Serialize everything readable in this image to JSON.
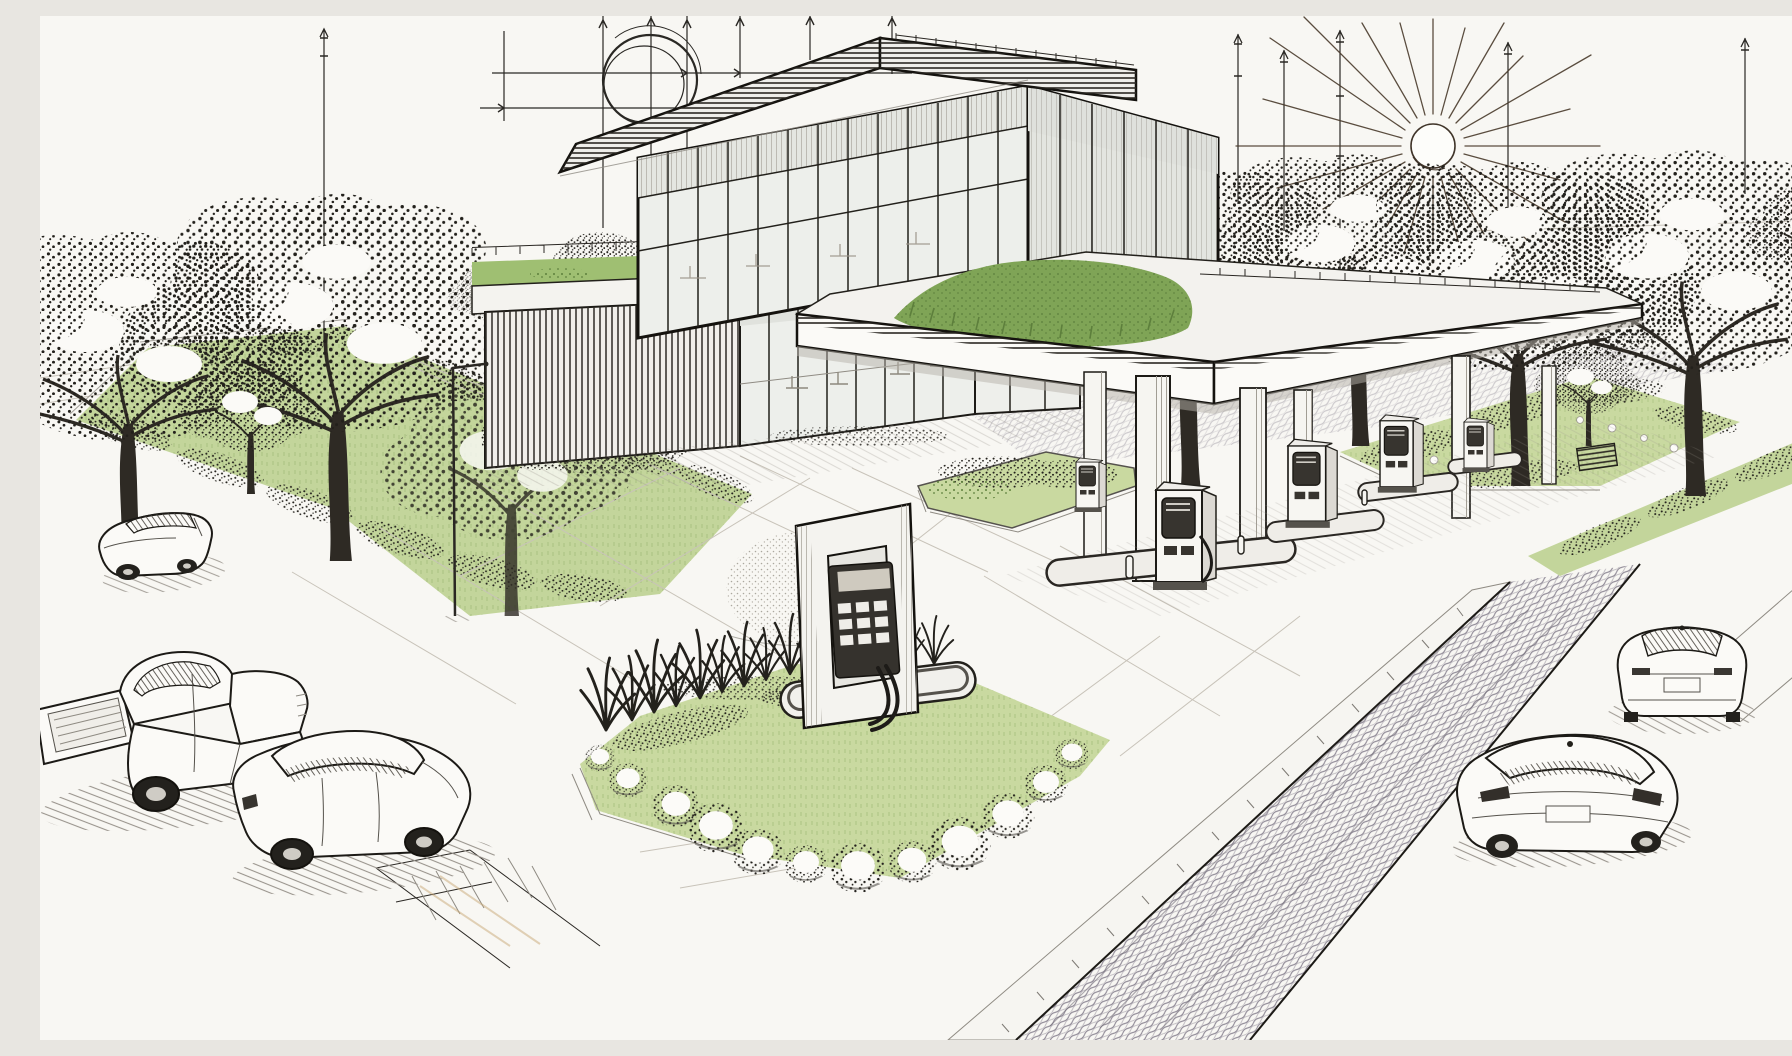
{
  "artwork": {
    "type": "architectural concept sketch",
    "medium": "ink line drawing with green wash accents",
    "view": "aerial three-quarter perspective",
    "subject": "eco gas station and EV charging forecourt with glass convenience building, planted green roofs, landscaped lawns, trees and cars"
  },
  "palette": {
    "paper": "#f8f7f3",
    "ink": "#22201b",
    "line_soft": "#8f8b83",
    "line_faint": "#c8c3b9",
    "sun_disc": "#fdfdfa",
    "sun_ray": "#4a3b2c",
    "lawn_light": "#c9d9a0",
    "lawn_mid": "#c3d59b",
    "lawn_deep": "#9fbf72",
    "plant_green": "#7fa456",
    "plant_green_dark": "#5d7f3c",
    "glass_light": "#edefeb",
    "glass_shade": "#e3e5e0",
    "surface_white": "#fbfaf7",
    "road_hatch": "#8d8794",
    "road_hatch_dark": "#6f6a74",
    "shadow_line": "#9a958e",
    "tan_accent": "#c7a876",
    "panel_dark": "#37342f"
  },
  "scene": {
    "sky_elements": [
      "sketched sun with radiating rays",
      "surveyor guide circle",
      "perspective guide lines with arrowheads",
      "antenna guide poles"
    ],
    "building": {
      "description": "two-storey glass pavilion",
      "features": [
        "flat overhanging hatched roof slab",
        "glass curtain wall",
        "green roof terrace with railing",
        "vertical louver screen",
        "storefront glazing with interior furniture"
      ]
    },
    "canopy": {
      "description": "flat forecourt canopy with planted green roof",
      "columns": 5,
      "fuel_dispensers": 5,
      "pump_islands": 4
    },
    "ev_charger": {
      "description": "freestanding charger frame on rounded island",
      "details": [
        "dark control panel with keypad",
        "charging hose",
        "rounded curb base"
      ]
    },
    "vehicles": [
      {
        "type": "sedan",
        "location": "street upper left"
      },
      {
        "type": "pickup-truck",
        "location": "parking lower left"
      },
      {
        "type": "sedan",
        "location": "parking lower left"
      },
      {
        "type": "sedan",
        "location": "street lower right far"
      },
      {
        "type": "sedan",
        "location": "street lower right near"
      }
    ],
    "landscape": [
      "stippled deciduous trees",
      "hedge-lined lawn median",
      "ornamental grass bed",
      "white flowering shrubs",
      "street light pole",
      "raised planter beds",
      "green verge along street"
    ],
    "roads": [
      "hatched asphalt street lower right",
      "white concrete forecourt with joint lines",
      "curb ramp with ladder hatching",
      "tick-hatched sidewalk band"
    ]
  }
}
